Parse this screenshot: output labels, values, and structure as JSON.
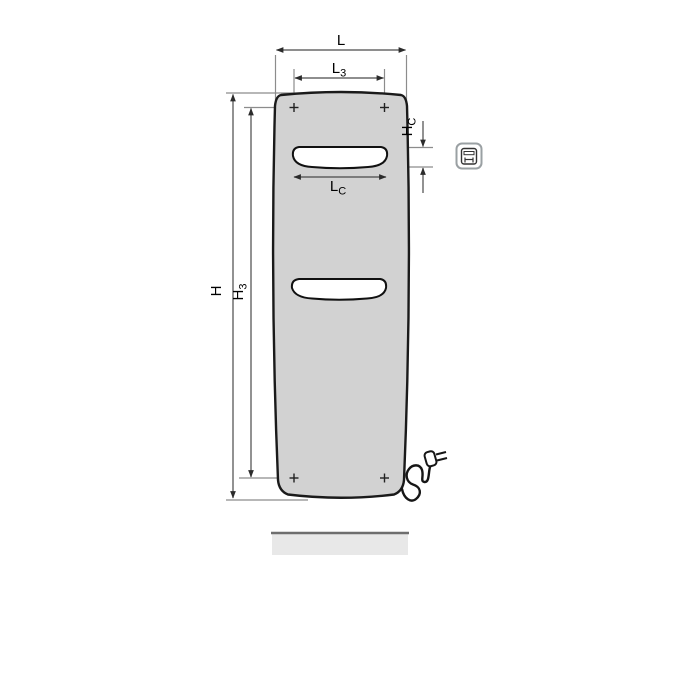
{
  "diagram": {
    "type": "technical-dimension-drawing",
    "subject": "electric panel radiator, front view with dimension lines, power cord with plug, and floor line",
    "labels": {
      "width_overall": {
        "base": "L",
        "sub": ""
      },
      "width_fixing": {
        "base": "L",
        "sub": "3"
      },
      "width_cutout": {
        "base": "L",
        "sub": "C"
      },
      "height_overall": {
        "base": "H",
        "sub": ""
      },
      "height_fixing": {
        "base": "H",
        "sub": "3"
      },
      "height_cutout": {
        "base": "H",
        "sub": "C"
      }
    },
    "colors": {
      "panel_fill": "#d2d2d2",
      "panel_outline": "#1a1a1a",
      "slot_fill": "#ffffff",
      "dimension_line": "#4a4a4a",
      "extension_line": "#8c8c8c",
      "arrow": "#2b2b2b",
      "text": "#000000",
      "floor_fill": "#e8e8e8",
      "floor_edge": "#6e6e6e",
      "icon_border": "#9aa0a3",
      "icon_glyph": "#333333"
    },
    "icon": {
      "name": "radiator-front-pictogram"
    }
  }
}
